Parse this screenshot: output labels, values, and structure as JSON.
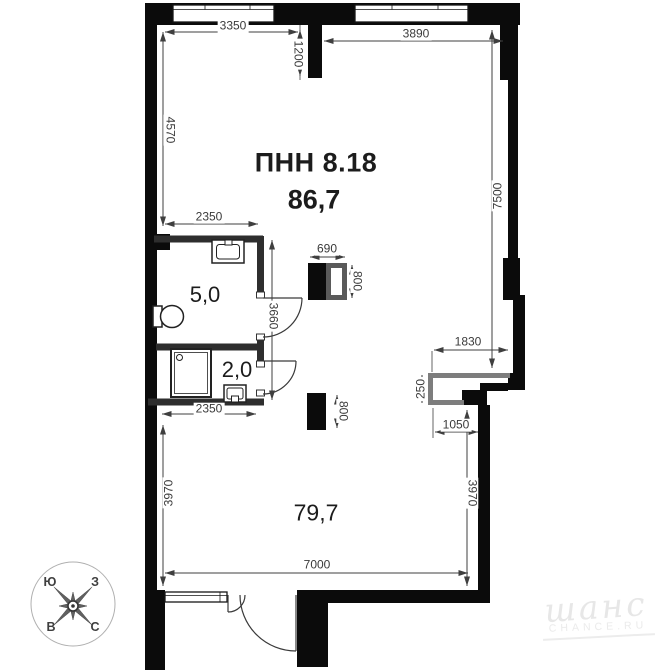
{
  "plan": {
    "unit_label": "ПНН 8.18",
    "total_area": "86,7",
    "rooms": {
      "bathroom": "5,0",
      "laundry": "2,0",
      "living": "79,7"
    },
    "dims": {
      "top_left": "3350",
      "top_stub": "1200",
      "top_right": "3890",
      "left_upper": "4570",
      "right_full": "7500",
      "bath_top": "2350",
      "column_width": "690",
      "column_height_top": "800",
      "bath_height": "3660",
      "niche_width": "1830",
      "niche_depth": "250",
      "bath_bottom": "2350",
      "column_height_bottom": "800",
      "ledge": "1050",
      "left_lower": "3970",
      "right_lower": "3970",
      "bottom": "7000"
    },
    "compass": {
      "top_left": "Ю",
      "top_right": "З",
      "bottom_left": "В",
      "bottom_right": "С"
    },
    "watermark": {
      "logo": "шанс",
      "caption": "CHANCE.RU"
    },
    "colors": {
      "wall": "#0b0b0b",
      "partition": "#2e2e2e",
      "dimension": "#3f3f3f",
      "niche": "#7d7d7d",
      "watermark": "#e9e9e9"
    }
  }
}
